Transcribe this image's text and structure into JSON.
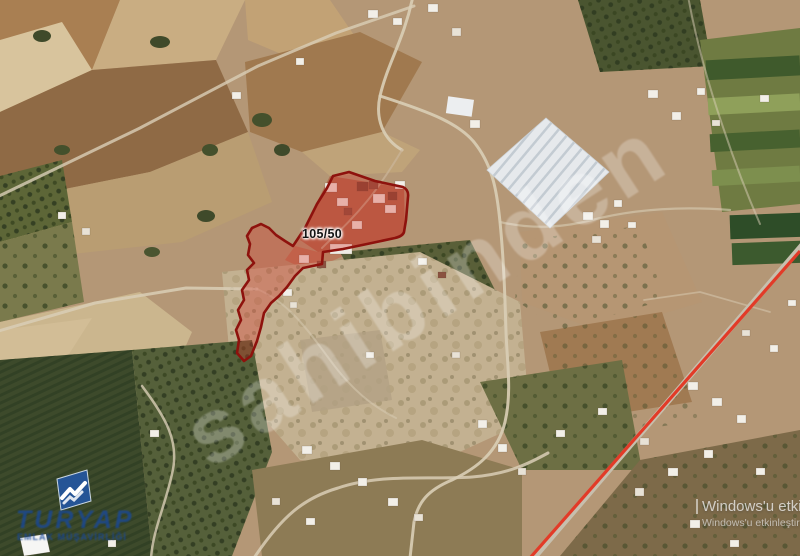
{
  "map": {
    "parcel": {
      "label": "105/50",
      "fill_color": "#D63026",
      "border_color": "#8E120D"
    },
    "highway_line_color": "#E23B28"
  },
  "watermark": {
    "text": "sahibinden"
  },
  "logo": {
    "brand": "TURYAP",
    "subtitle": "EMLAK MÜŞAVİRLİĞİ",
    "color": "#2456A0",
    "icon": "handshake-icon"
  },
  "activation": {
    "line1": "Windows'u etkinleştir",
    "line2": "Windows'u etkinleştirmek için Ayarlar'a gidin."
  }
}
